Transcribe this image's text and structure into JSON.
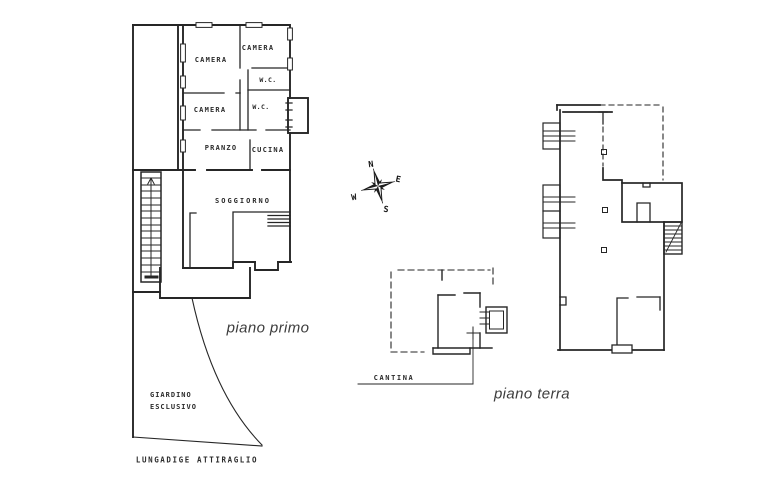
{
  "page": {
    "background": "#ffffff",
    "ink_color": "#262626",
    "caption_color": "#3d3d3d"
  },
  "floorplan": {
    "piano_primo": {
      "caption": "piano primo",
      "rooms": {
        "camera_top_left": "CAMERA",
        "camera_top_right": "CAMERA",
        "wc_upper": "W.C.",
        "camera_mid": "CAMERA",
        "wc_lower": "W.C.",
        "pranzo": "PRANZO",
        "cucina": "CUCINA",
        "soggiorno": "SOGGIORNO"
      },
      "garden_label_line1": "GIARDINO",
      "garden_label_line2": "ESCLUSIVO",
      "street_label": "LUNGADIGE  ATTIRAGLIO"
    },
    "piano_terra": {
      "caption": "piano terra",
      "cantina_label": "CANTINA"
    },
    "compass": {
      "north": "N",
      "east": "E",
      "south": "S",
      "west": "W"
    }
  }
}
